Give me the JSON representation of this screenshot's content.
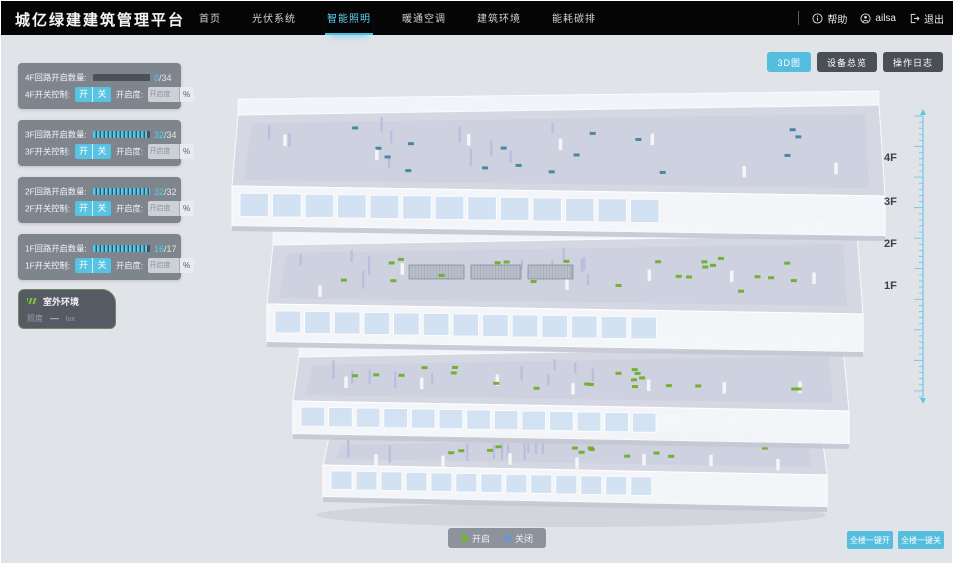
{
  "header": {
    "brand": "城亿绿建建筑管理平台",
    "nav": [
      {
        "label": "首页"
      },
      {
        "label": "光伏系统"
      },
      {
        "label": "智能照明",
        "active": true
      },
      {
        "label": "暖通空调"
      },
      {
        "label": "建筑环境"
      },
      {
        "label": "能耗碳排"
      }
    ],
    "actions": {
      "help": "帮助",
      "user": "ailsa",
      "logout": "退出"
    }
  },
  "view_buttons": [
    {
      "label": "3D图",
      "active": true
    },
    {
      "label": "设备总览"
    },
    {
      "label": "操作日志"
    }
  ],
  "floor_panels": [
    {
      "floor": "4F",
      "count_label": "4F回路开启数量:",
      "open_count": "0",
      "total_display": "/34",
      "percent": 0,
      "switch_label": "4F开关控制:",
      "on_label": "开",
      "off_label": "关",
      "dim_label": "开启度:",
      "dim_placeholder": "开启度",
      "percent_sign": "%"
    },
    {
      "floor": "3F",
      "count_label": "3F回路开启数量:",
      "open_count": "32",
      "total_display": "/34",
      "percent": 94,
      "switch_label": "3F开关控制:",
      "on_label": "开",
      "off_label": "关",
      "dim_label": "开启度:",
      "dim_placeholder": "开启度",
      "percent_sign": "%"
    },
    {
      "floor": "2F",
      "count_label": "2F回路开启数量:",
      "open_count": "32",
      "total_display": "/32",
      "percent": 100,
      "switch_label": "2F开关控制:",
      "on_label": "开",
      "off_label": "关",
      "dim_label": "开启度:",
      "dim_placeholder": "开启度",
      "percent_sign": "%"
    },
    {
      "floor": "1F",
      "count_label": "1F回路开启数量:",
      "open_count": "16",
      "total_display": "/17",
      "percent": 94,
      "switch_label": "1F开关控制:",
      "on_label": "开",
      "off_label": "关",
      "dim_label": "开启度:",
      "dim_placeholder": "开启度",
      "percent_sign": "%"
    }
  ],
  "outdoor": {
    "title": "室外环境",
    "metric": "照度",
    "value": "—",
    "unit": "lux"
  },
  "building": {
    "floor_labels": [
      "4F",
      "3F",
      "2F",
      "1F"
    ]
  },
  "legend": {
    "on": "开启",
    "off": "关闭"
  },
  "bulk_buttons": [
    {
      "label": "全楼一键开"
    },
    {
      "label": "全楼一键关"
    }
  ],
  "colors": {
    "accent": "#4fc3e8",
    "legend_on": "#76b043",
    "legend_off": "#6d95cc",
    "dot_on": "#6fae2c",
    "dot_off": "#41849f"
  }
}
